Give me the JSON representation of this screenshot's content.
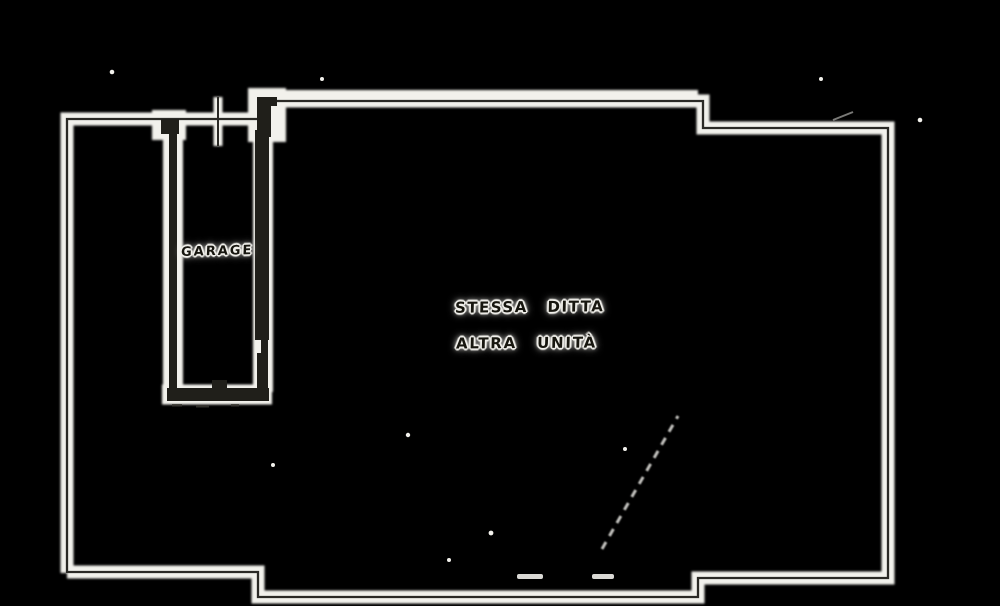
{
  "plan": {
    "labels": {
      "garage": "GARAGE",
      "annotation_line1": "STESSA DITTA",
      "annotation_line2": "ALTRA UNITÀ"
    },
    "colors": {
      "background": "#000000",
      "paper_halo": "#f2f1ec",
      "ink_thin_line": "#2b2a26",
      "ink_thick_wall": "#201f1a"
    }
  }
}
